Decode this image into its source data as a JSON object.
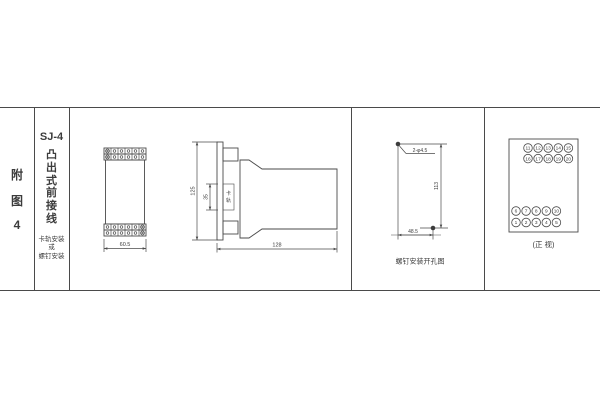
{
  "left_panel": {
    "figure_label_chars": [
      "附",
      "图",
      "4"
    ],
    "model": "SJ-4",
    "title_chars": [
      "凸",
      "出",
      "式",
      "前",
      "接",
      "线"
    ],
    "mounting_note_lines": [
      "卡轨安装",
      "或",
      "螺钉安装"
    ]
  },
  "outline_front_view": {
    "width_dim": "60.5"
  },
  "side_view": {
    "height_dim": "125",
    "rail_slot_dim": "35",
    "rail_label_chars": [
      "卡",
      "轨"
    ],
    "depth_dim": "128"
  },
  "drill_view": {
    "hole_spec": "2-φ4.5",
    "vertical_dim": "113",
    "horizontal_dim": "48.5",
    "caption": "螺钉安装开孔图"
  },
  "terminal_view": {
    "caption": "(正 视)",
    "rows": [
      [
        "11",
        "12",
        "13",
        "14",
        "15"
      ],
      [
        "16",
        "17",
        "18",
        "19",
        "20"
      ],
      [
        "6",
        "7",
        "8",
        "9",
        "10"
      ],
      [
        "1",
        "2",
        "3",
        "4",
        "5"
      ]
    ]
  }
}
